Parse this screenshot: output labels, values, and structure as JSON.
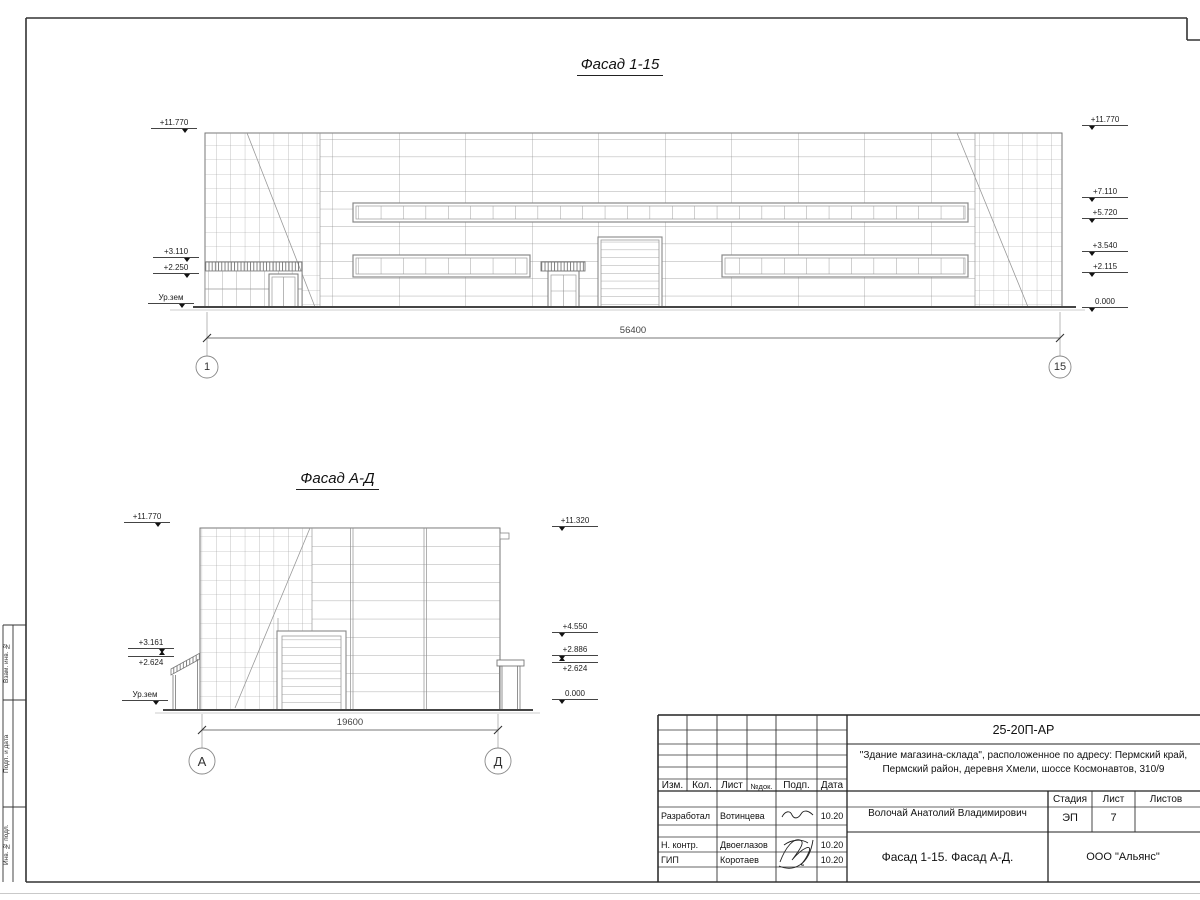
{
  "titles": {
    "facade1": "Фасад 1-15",
    "facade2": "Фасад А-Д"
  },
  "facade1": {
    "dimension": "56400",
    "axis_left": "1",
    "axis_right": "15",
    "elev_left": [
      "+11.770",
      "+3.110",
      "+2.250",
      "Ур.зем"
    ],
    "elev_right": [
      "+11.770",
      "+7.110",
      "+5.720",
      "+3.540",
      "+2.115",
      "0.000"
    ]
  },
  "facade2": {
    "dimension": "19600",
    "axis_left": "А",
    "axis_right": "Д",
    "elev_left": [
      "+11.770",
      "+3.161",
      "+2.624",
      "Ур.зем"
    ],
    "elev_right": [
      "+11.320",
      "+4.550",
      "+2.886",
      "+2.624",
      "0.000"
    ]
  },
  "side_strip": {
    "labels": [
      "Взам. инв. №",
      "Подп. и дата",
      "Инв. № подл."
    ]
  },
  "title_block": {
    "doc_number": "25-20П-АР",
    "project_line1": "\"Здание магазина-склада\", расположенное по адресу: Пермский край,",
    "project_line2": "Пермский район, деревня Хмели, шоссе Космонавтов, 310/9",
    "header": {
      "izm": "Изм.",
      "kol": "Кол.",
      "list": "Лист",
      "ndok": "№док.",
      "podp": "Подп.",
      "data": "Дата"
    },
    "rows": [
      {
        "role": "Разработал",
        "name": "Вотинцева",
        "date": "10.20"
      },
      {
        "role": "Н. контр.",
        "name": "Двоеглазов",
        "date": "10.20"
      },
      {
        "role": "ГИП",
        "name": "Коротаев",
        "date": "10.20"
      }
    ],
    "chief": "Волочай Анатолий Владимирович",
    "stage_label": "Стадия",
    "sheet_label": "Лист",
    "sheets_label": "Листов",
    "stage": "ЭП",
    "sheet": "7",
    "sheet_title": "Фасад 1-15. Фасад А-Д.",
    "company": "ООО \"Альянс\""
  }
}
